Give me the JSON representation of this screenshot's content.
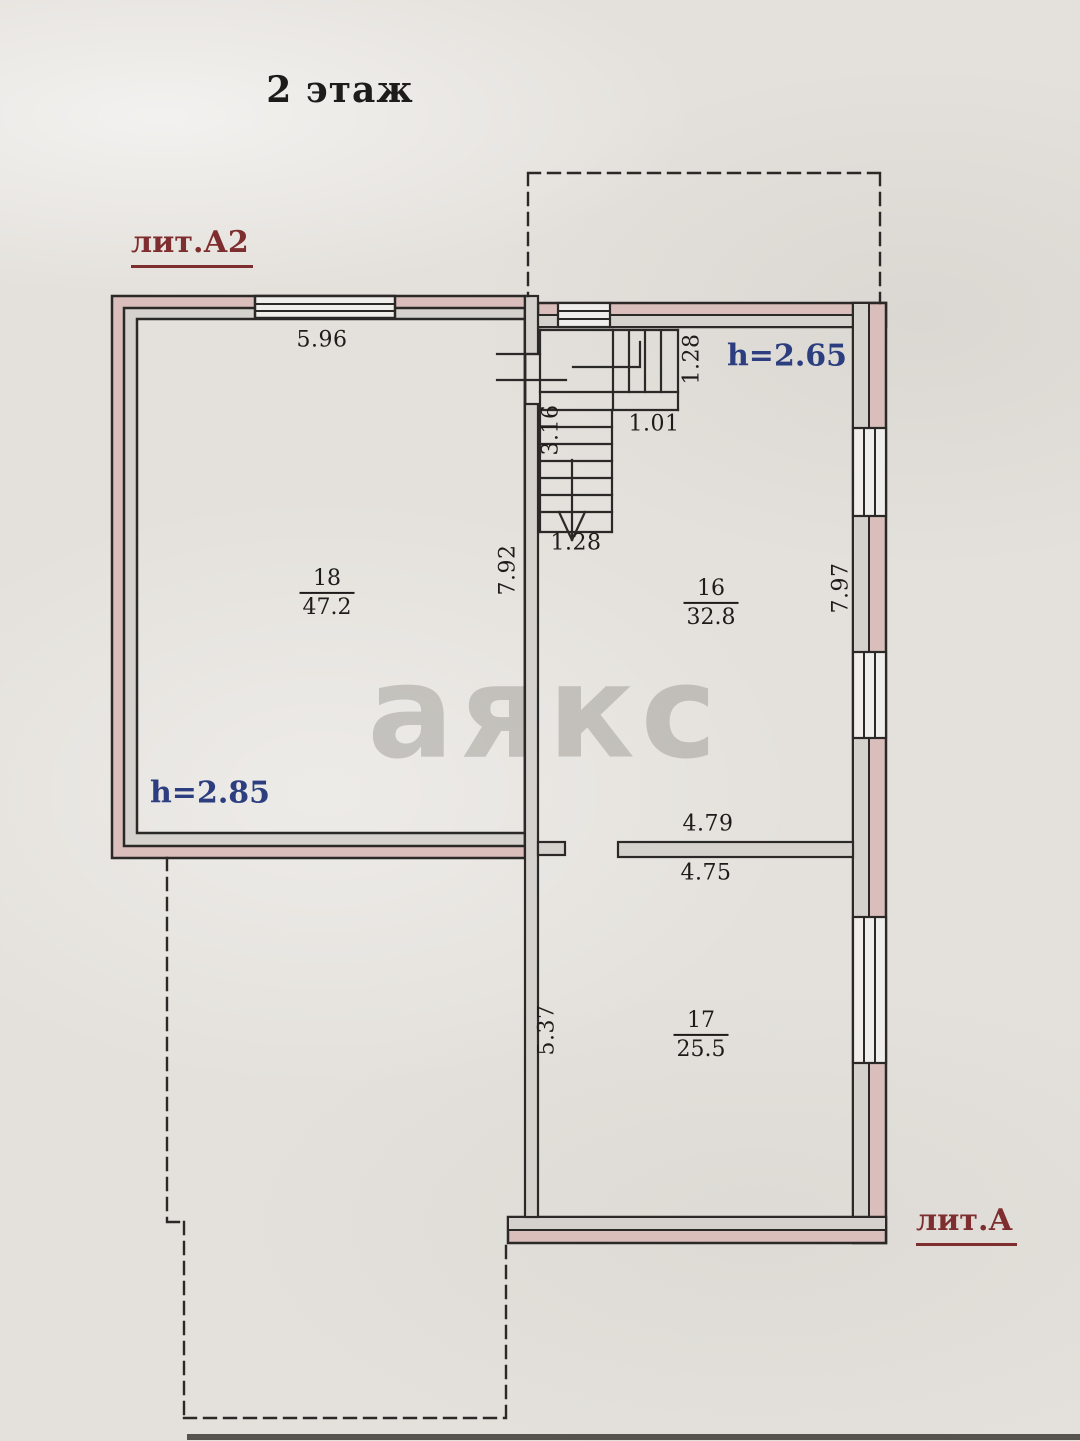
{
  "title": "2 этаж",
  "watermark": "аякс",
  "litera_a2": {
    "label": "лит.А2",
    "height": "h=2.85"
  },
  "litera_a": {
    "label": "лит.А",
    "height": "h=2.65"
  },
  "rooms": {
    "r18": {
      "number": "18",
      "area": "47.2"
    },
    "r16": {
      "number": "16",
      "area": "32.8"
    },
    "r17": {
      "number": "17",
      "area": "25.5"
    }
  },
  "dimensions": {
    "top_wall_width": "5.96",
    "stairs_upper_flight_width": "1.28",
    "stairs_landing_width": "1.01",
    "stairs_flight_length": "3.16",
    "stairs_lower_flight_width": "1.28",
    "room18_depth": "7.92",
    "room16_depth": "7.97",
    "partition_upper": "4.79",
    "partition_lower": "4.75",
    "room17_depth": "5.37"
  },
  "colors": {
    "wall_pink": "#d9bebc",
    "wall_gray": "#d5d2cd",
    "window_fill": "#f0eeea",
    "line": "#2b2927",
    "label_red": "#7e2e2e",
    "label_blue": "#2c3e7f",
    "paper": "#e4e1dc"
  }
}
